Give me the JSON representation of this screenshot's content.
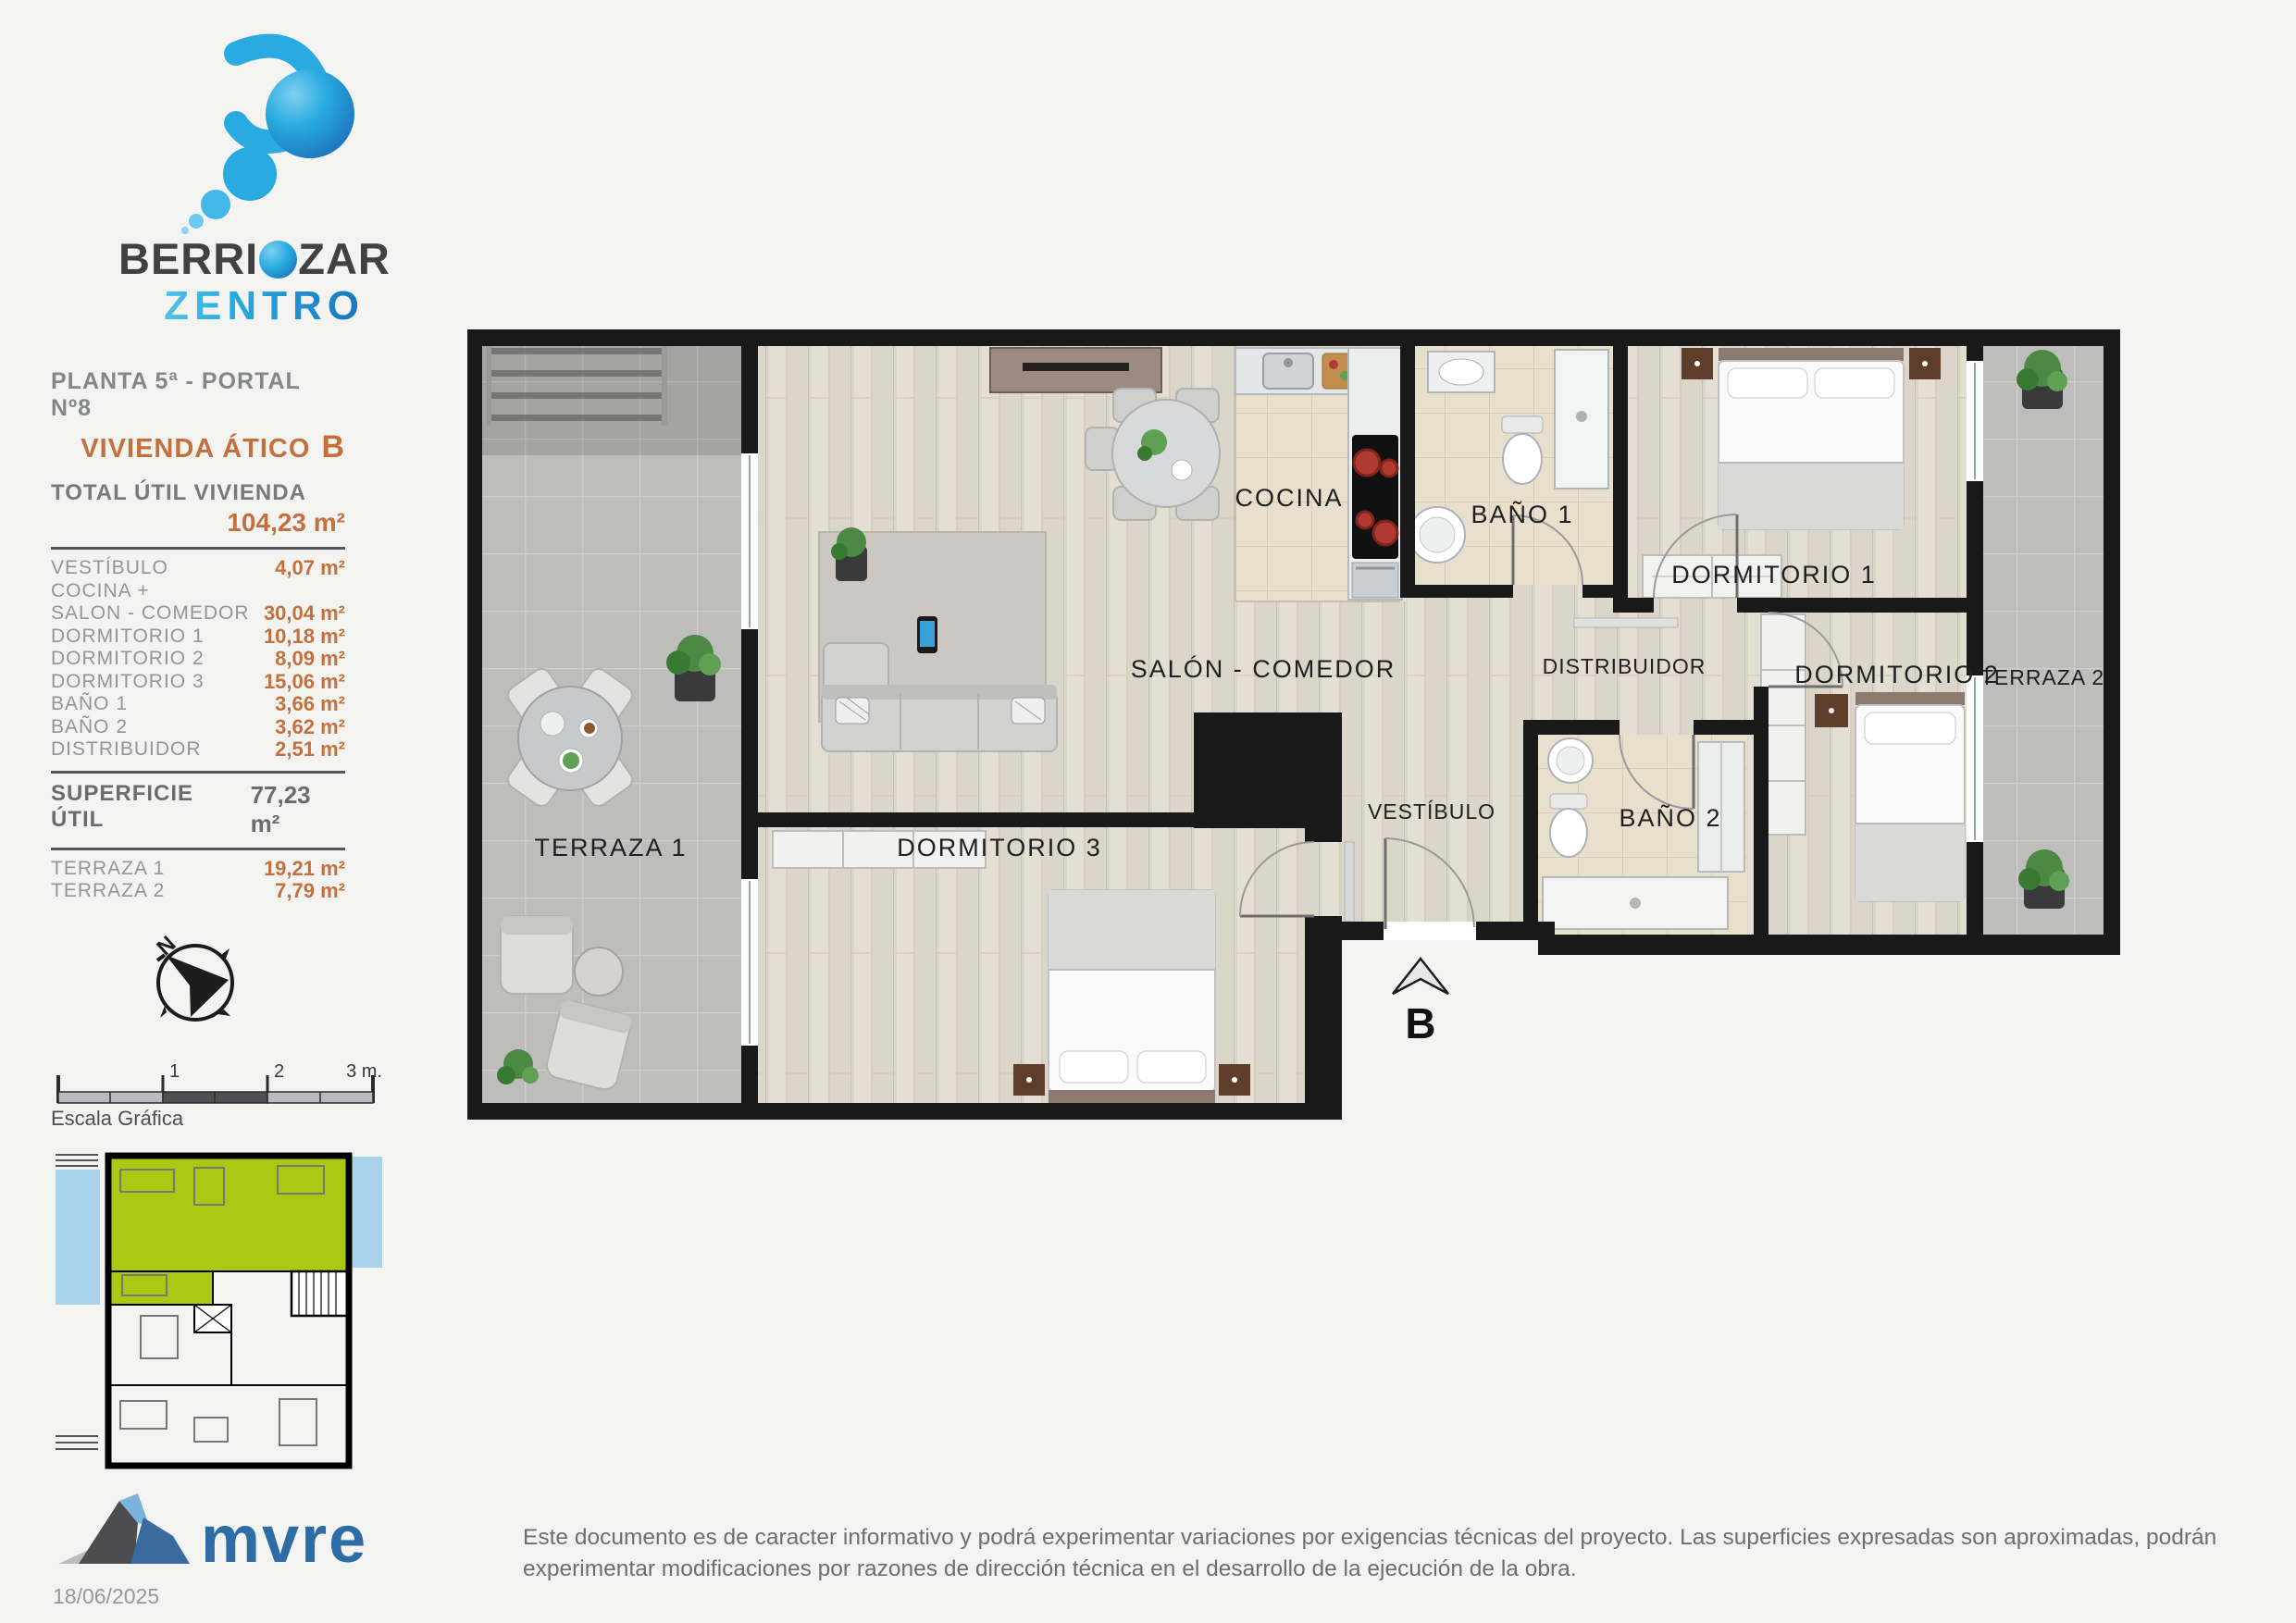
{
  "branding": {
    "logo_word_start": "BERRI",
    "logo_word_end": "ZAR",
    "logo_line2": "ZENTRO",
    "developer": "mvre",
    "date": "18/06/2025"
  },
  "header": {
    "plan_line": "PLANTA 5ª - PORTAL Nº8",
    "unit_name": "VIVIENDA ÁTICO",
    "unit_letter": "B",
    "total_label": "TOTAL ÚTIL VIVIENDA",
    "total_value": "104,23 m²"
  },
  "areas": {
    "rows": [
      {
        "label": "VESTÍBULO",
        "value": "4,07 m²"
      },
      {
        "label": "COCINA +",
        "value": ""
      },
      {
        "label": "SALON - COMEDOR",
        "value": "30,04 m²"
      },
      {
        "label": "DORMITORIO 1",
        "value": "10,18 m²"
      },
      {
        "label": "DORMITORIO 2",
        "value": "8,09 m²"
      },
      {
        "label": "DORMITORIO 3",
        "value": "15,06 m²"
      },
      {
        "label": "BAÑO 1",
        "value": "3,66 m²"
      },
      {
        "label": "BAÑO 2",
        "value": "3,62 m²"
      },
      {
        "label": "DISTRIBUIDOR",
        "value": "2,51 m²"
      }
    ],
    "superficie_label": "SUPERFICIE ÚTIL",
    "superficie_value": "77,23 m²",
    "terrazas": [
      {
        "label": "TERRAZA 1",
        "value": "19,21 m²"
      },
      {
        "label": "TERRAZA 2",
        "value": "7,79 m²"
      }
    ]
  },
  "compass": {
    "north": "N"
  },
  "scalebar": {
    "t1": "1",
    "t2": "2",
    "t3": "3 m.",
    "caption": "Escala Gráfica"
  },
  "plan": {
    "rooms": {
      "cocina": "COCINA",
      "bano1": "BAÑO 1",
      "dormitorio1": "DORMITORIO 1",
      "salon": "SALÓN - COMEDOR",
      "distribuidor": "DISTRIBUIDOR",
      "dormitorio2": "DORMITORIO 2",
      "terraza2": "TERRAZA 2",
      "vestibulo": "VESTÍBULO",
      "bano2": "BAÑO 2",
      "terraza1": "TERRAZA 1",
      "dormitorio3": "DORMITORIO 3"
    },
    "entrance_letter": "B"
  },
  "footer": {
    "disclaimer": "Este documento es de caracter informativo y podrá experimentar variaciones por exigencias técnicas del proyecto. Las superficies expresadas son aproximadas, podrán experimentar modificaciones por razones de dirección técnica en el desarrollo de la ejecución de la obra."
  },
  "colors": {
    "accent_orange": "#c4703c",
    "logo_blue_dark": "#1b75bc",
    "logo_cyan": "#29abe1",
    "keyplan_green": "#abc813",
    "keyplan_blue": "#a9d3ea",
    "wall_black": "#191919"
  }
}
